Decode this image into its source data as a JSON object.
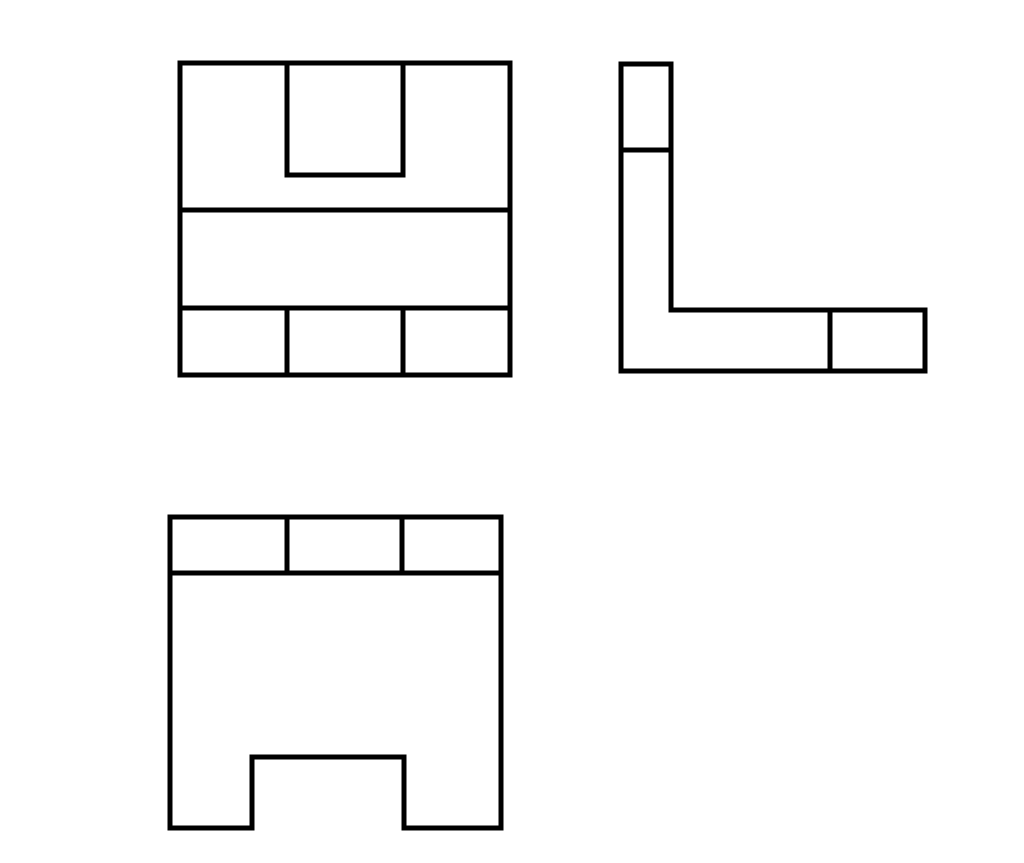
{
  "drawing": {
    "background_color": "#ffffff",
    "stroke_color": "#000000",
    "stroke_width": 5,
    "views": [
      {
        "id": "top-view",
        "shapes": [
          {
            "name": "top-view-outline",
            "type": "polygon",
            "points": [
              [
                180,
                63
              ],
              [
                510,
                63
              ],
              [
                510,
                375
              ],
              [
                180,
                375
              ]
            ]
          },
          {
            "name": "top-view-slot-edge",
            "type": "polyline",
            "points": [
              [
                287,
                63
              ],
              [
                287,
                175
              ],
              [
                403,
                175
              ],
              [
                403,
                63
              ]
            ]
          },
          {
            "name": "top-view-step-edge-upper",
            "type": "line",
            "points": [
              [
                180,
                210
              ],
              [
                510,
                210
              ]
            ]
          },
          {
            "name": "top-view-step-edge-lower",
            "type": "line",
            "points": [
              [
                180,
                308
              ],
              [
                510,
                308
              ]
            ]
          },
          {
            "name": "top-view-rib-edge-left",
            "type": "line",
            "points": [
              [
                287,
                308
              ],
              [
                287,
                375
              ]
            ]
          },
          {
            "name": "top-view-rib-edge-right",
            "type": "line",
            "points": [
              [
                403,
                308
              ],
              [
                403,
                375
              ]
            ]
          }
        ]
      },
      {
        "id": "right-side-view",
        "shapes": [
          {
            "name": "side-view-outline",
            "type": "polygon",
            "points": [
              [
                621,
                64
              ],
              [
                671,
                64
              ],
              [
                671,
                310
              ],
              [
                925,
                310
              ],
              [
                925,
                371
              ],
              [
                621,
                371
              ]
            ]
          },
          {
            "name": "side-view-step-edge",
            "type": "line",
            "points": [
              [
                621,
                150
              ],
              [
                671,
                150
              ]
            ]
          },
          {
            "name": "side-view-rib-edge",
            "type": "line",
            "points": [
              [
                830,
                310
              ],
              [
                830,
                371
              ]
            ]
          }
        ]
      },
      {
        "id": "front-view",
        "shapes": [
          {
            "name": "front-view-outline",
            "type": "polygon",
            "points": [
              [
                170,
                517
              ],
              [
                501,
                517
              ],
              [
                501,
                828
              ],
              [
                404,
                828
              ],
              [
                404,
                757
              ],
              [
                252,
                757
              ],
              [
                252,
                828
              ],
              [
                170,
                828
              ]
            ]
          },
          {
            "name": "front-view-step-edge",
            "type": "line",
            "points": [
              [
                170,
                573
              ],
              [
                501,
                573
              ]
            ]
          },
          {
            "name": "front-view-rib-edge-left",
            "type": "line",
            "points": [
              [
                287,
                517
              ],
              [
                287,
                573
              ]
            ]
          },
          {
            "name": "front-view-rib-edge-right",
            "type": "line",
            "points": [
              [
                402,
                517
              ],
              [
                402,
                573
              ]
            ]
          }
        ]
      }
    ]
  }
}
